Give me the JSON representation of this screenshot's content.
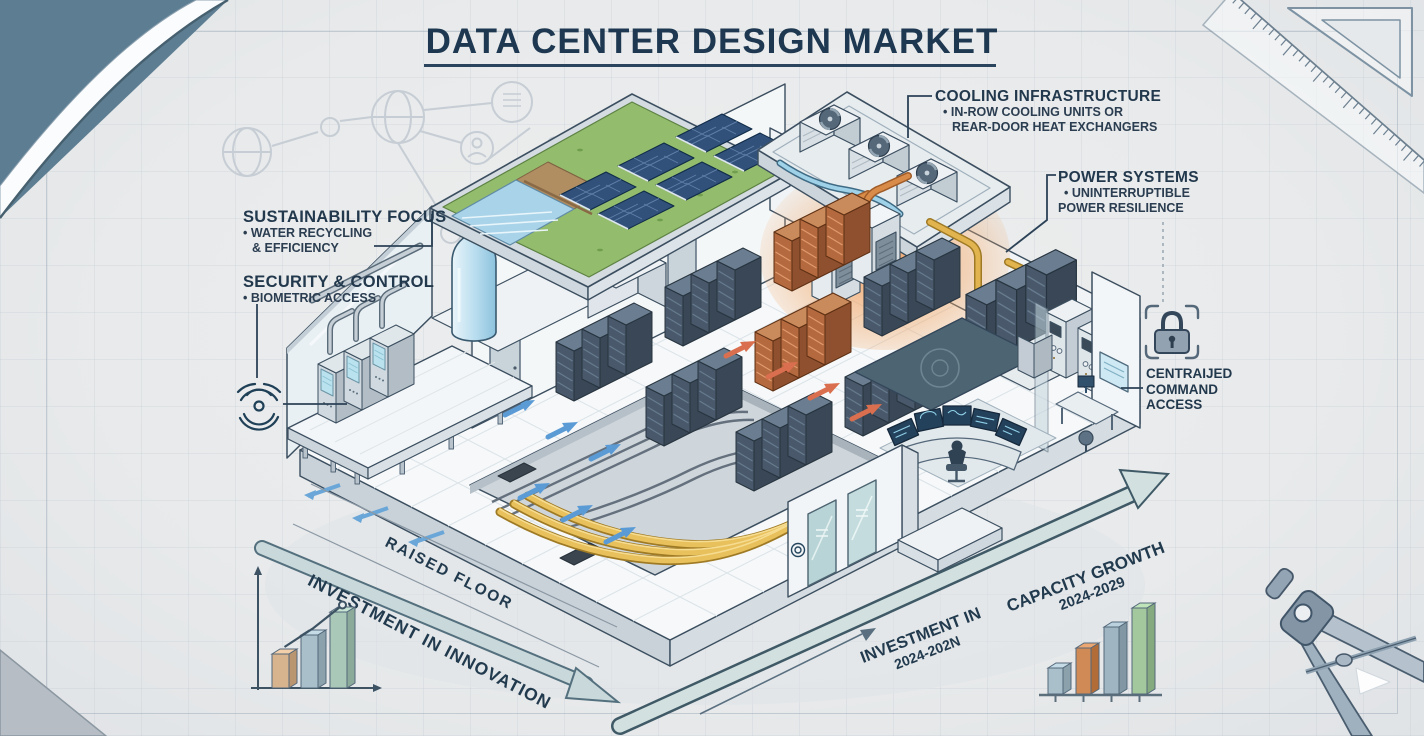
{
  "title": {
    "text": "DATA CENTER DESIGN MARKET"
  },
  "callouts": {
    "cooling": {
      "heading": "COOLING INFRASTRUCTURE",
      "bullet1": "• IN-ROW COOLING UNITS OR",
      "bullet2": "REAR-DOOR HEAT EXCHANGERS"
    },
    "power": {
      "heading": "POWER SYSTEMS",
      "bullet1": "• UNINTERRUPTIBLE",
      "bullet2": "POWER RESILIENCE"
    },
    "sustainability": {
      "heading": "SUSTAINABILITY FOCUS",
      "bullet1": "• WATER RECYCLING",
      "bullet2": "& EFFICIENCY"
    },
    "security": {
      "heading": "SECURITY & CONTROL",
      "bullet1": "• BIOMETRIC ACCESS"
    },
    "command": {
      "line1": "CENTRAIJED",
      "line2": "COMMAND",
      "line3": "ACCESS"
    }
  },
  "annotations": {
    "raised_floor": "RAISED FLOOR",
    "investment_innovation": "INVESTMENT IN INNOVATION",
    "investment_period_line1": "INVESTMENT IN",
    "investment_period_line2": "2024-202N",
    "capacity_growth_line1": "CAPACITY GROWTH",
    "capacity_growth_line2": "2024-2029"
  },
  "mini_charts": {
    "innovation": {
      "type": "bar",
      "values": [
        34,
        53,
        76
      ],
      "colors": [
        "#d8b48e",
        "#a9c0cb",
        "#a9c8b8"
      ],
      "trend": true,
      "ticks": false
    },
    "capacity": {
      "type": "bar",
      "values": [
        26,
        46,
        67,
        86
      ],
      "colors": [
        "#a9c0cb",
        "#d08a55",
        "#9fb6c2",
        "#a3c89d"
      ],
      "trend": false,
      "ticks": true
    }
  },
  "palette": {
    "title_color": "#1d3850",
    "label_color": "#23394d",
    "paper": "#e9ebec",
    "fold_blue": "#5d7e92",
    "hot_accent": "#d98c4a",
    "cold_accent": "#5b9bd5",
    "conduit_yellow": "#e2b44f"
  }
}
